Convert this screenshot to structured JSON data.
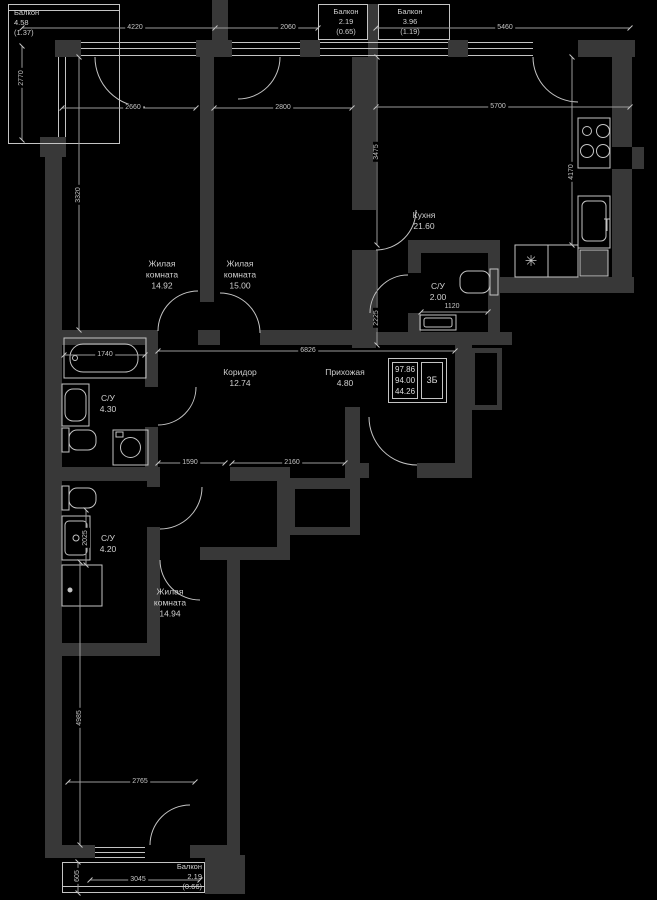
{
  "plan": {
    "rooms": [
      {
        "key": "living1",
        "name_lines": [
          "Жилая",
          "комната"
        ],
        "area": "14.92"
      },
      {
        "key": "living2",
        "name_lines": [
          "Жилая",
          "комната"
        ],
        "area": "15.00"
      },
      {
        "key": "kitchen",
        "name_lines": [
          "Кухня"
        ],
        "area": "21.60"
      },
      {
        "key": "wc_small",
        "name_lines": [
          "С/У"
        ],
        "area": "2.00"
      },
      {
        "key": "corridor",
        "name_lines": [
          "Коридор"
        ],
        "area": "12.74"
      },
      {
        "key": "hallway",
        "name_lines": [
          "Прихожая"
        ],
        "area": "4.80"
      },
      {
        "key": "bathroom1",
        "name_lines": [
          "С/У"
        ],
        "area": "4.30"
      },
      {
        "key": "bathroom2",
        "name_lines": [
          "С/У"
        ],
        "area": "4.20"
      },
      {
        "key": "living3",
        "name_lines": [
          "Жилая",
          "комната"
        ],
        "area": "14.94"
      }
    ],
    "balconies": [
      {
        "key": "top_left",
        "name": "Балкон",
        "area": "4.58",
        "reduced": "(1.37)"
      },
      {
        "key": "top_mid",
        "name": "Балкон",
        "area": "2.19",
        "reduced": "(0.65)"
      },
      {
        "key": "top_right",
        "name": "Балкон",
        "area": "3.96",
        "reduced": "(1.19)"
      },
      {
        "key": "bottom",
        "name": "Балкон",
        "area": "2.19",
        "reduced": "(0.66)"
      }
    ],
    "info_box": {
      "area_total": "97.86",
      "area_no_balcony": "94.00",
      "area_living": "44.26",
      "flat_type": "3Б"
    },
    "dimensions": {
      "d4220": "4220",
      "d2060": "2060",
      "d5460": "5460",
      "d2770": "2770",
      "d2660": "2660",
      "d2800": "2800",
      "d5700": "5700",
      "d3320": "3320",
      "d3475": "3475",
      "d4170": "4170",
      "d2225": "2225",
      "d1740": "1740",
      "d6826": "6826",
      "d1590": "1590",
      "d2160": "2160",
      "d1120": "1120",
      "d2025": "2025",
      "d4985": "4985",
      "d2765": "2765",
      "d3045": "3045",
      "d605": "605"
    },
    "icons": {
      "cooktop_symbol": "✳"
    }
  },
  "colors": {
    "background": "#000000",
    "wall": "#383838",
    "line": "#c4c4c4"
  }
}
